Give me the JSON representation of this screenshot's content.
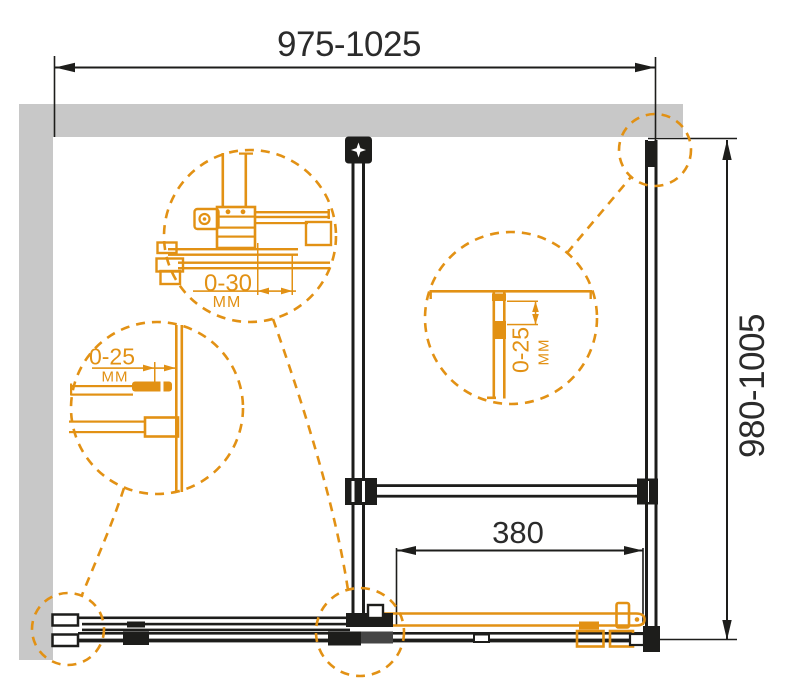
{
  "dimensions": {
    "width_range": "975-1025",
    "height_range": "980-1005",
    "door_travel": "380"
  },
  "details": {
    "top": {
      "range": "0-30",
      "unit": "MM"
    },
    "left": {
      "range": "0-25",
      "unit": "MM"
    },
    "middle": {
      "range": "0-25",
      "unit": "MM"
    }
  },
  "colors": {
    "accent_orange": "#E29114",
    "line_black": "#1D1D1B",
    "wall_gray": "#C8C8C8",
    "background": "#FFFFFF"
  }
}
